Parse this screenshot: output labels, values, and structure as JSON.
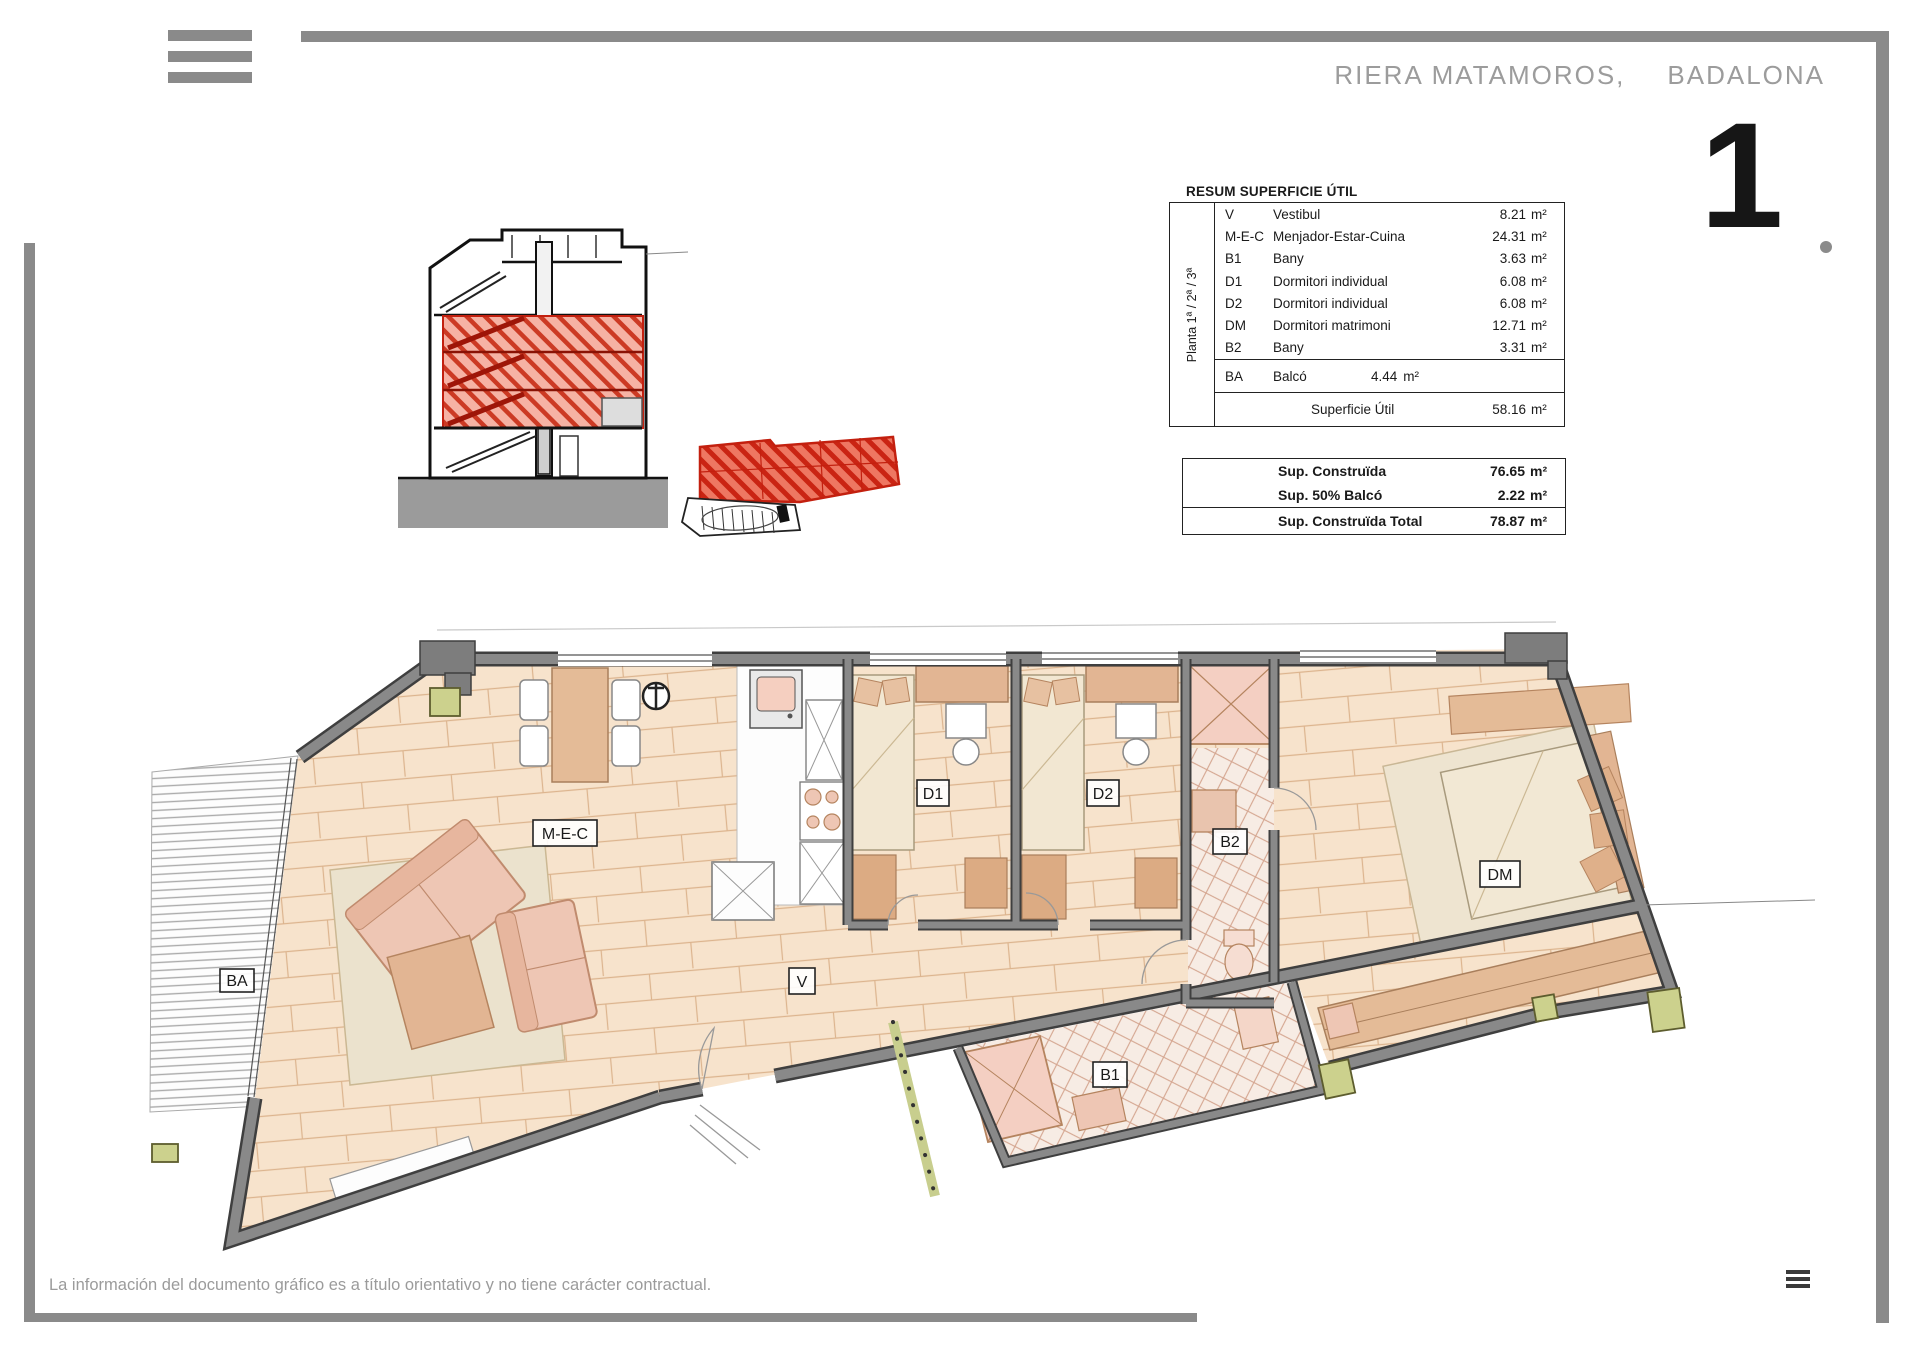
{
  "header": {
    "project": "RIERA MATAMOROS,",
    "city": "BADALONA",
    "page_number": "1"
  },
  "icons": {
    "top_left": "menu-icon",
    "bottom_right": "menu-icon"
  },
  "summary_table": {
    "title": "RESUM SUPERFICIE ÚTIL",
    "floor_label": "Planta 1ª / 2ª / 3ª",
    "unit": "m²",
    "rows": [
      {
        "code": "V",
        "name": "Vestibul",
        "area": "8.21"
      },
      {
        "code": "M-E-C",
        "name": "Menjador-Estar-Cuina",
        "area": "24.31"
      },
      {
        "code": "B1",
        "name": "Bany",
        "area": "3.63"
      },
      {
        "code": "D1",
        "name": "Dormitori individual",
        "area": "6.08"
      },
      {
        "code": "D2",
        "name": "Dormitori individual",
        "area": "6.08"
      },
      {
        "code": "DM",
        "name": "Dormitori matrimoni",
        "area": "12.71"
      },
      {
        "code": "B2",
        "name": "Bany",
        "area": "3.31"
      }
    ],
    "balcony_row": {
      "code": "BA",
      "name": "Balcó",
      "area": "4.44"
    },
    "total_row": {
      "label": "Superficie Útil",
      "area": "58.16"
    }
  },
  "construction_table": {
    "unit": "m²",
    "rows": [
      {
        "label": "Sup. Construïda",
        "area": "76.65"
      },
      {
        "label": "Sup. 50% Balcó",
        "area": "2.22"
      },
      {
        "label": "Sup. Construïda Total",
        "area": "78.87"
      }
    ]
  },
  "floor_plan": {
    "labels": {
      "mec": "M-E-C",
      "v": "V",
      "d1": "D1",
      "d2": "D2",
      "dm": "DM",
      "b1": "B1",
      "b2": "B2",
      "ba": "BA"
    }
  },
  "footer": {
    "disclaimer": "La información del documento gráfico es a título orientativo y no tiene carácter contractual."
  },
  "colors": {
    "frame_gray": "#8a8a8a",
    "wall_gray": "#7e7e7e",
    "wood": "#f7e3cc",
    "accent_red": "#cc2413",
    "pillar_green": "#ccd18d",
    "furniture_pink": "#eec6b4"
  }
}
